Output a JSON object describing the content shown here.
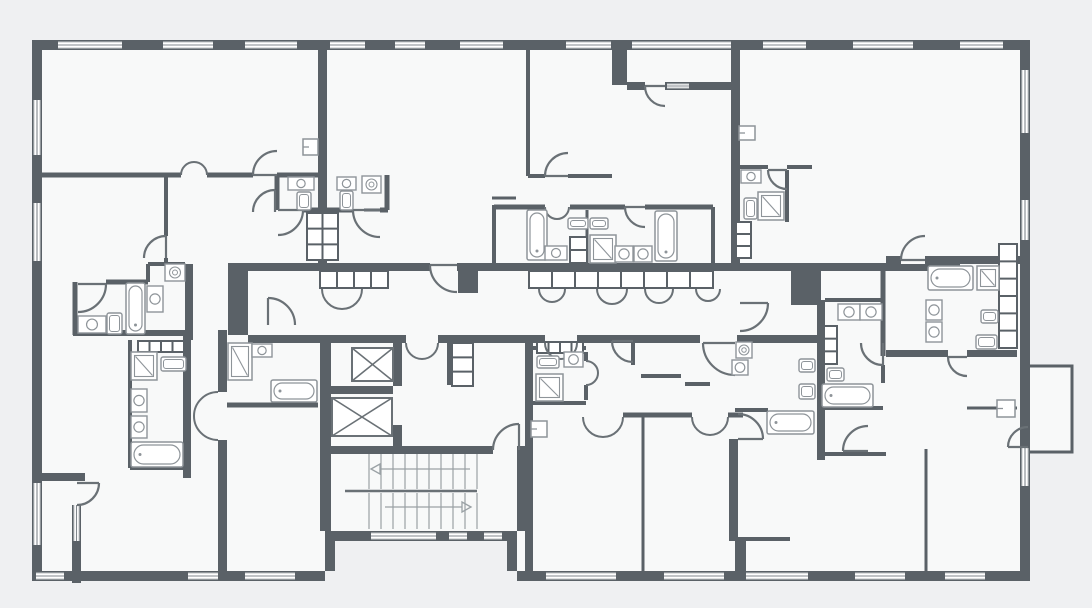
{
  "type": "floor-plan",
  "plan": {
    "canvas": {
      "w": 1092,
      "h": 608
    },
    "colors": {
      "background": "#eff0f2",
      "room": "#f8f9f9",
      "wall": "#5a6167",
      "door": "#6a7176",
      "fixture": "#8e9499",
      "window_line": "#80878c",
      "tread": "#9aa1a5"
    },
    "footprint": "M32,40 H1030 V581 H517 V541 H325 V581 H32 Z",
    "balconies": [
      [
        1028,
        366,
        44,
        86
      ]
    ],
    "walls": [
      [
        32,
        40,
        998,
        10
      ],
      [
        32,
        50,
        10,
        531
      ],
      [
        1020,
        50,
        10,
        531
      ],
      [
        32,
        571,
        293,
        10
      ],
      [
        325,
        531,
        192,
        10
      ],
      [
        325,
        541,
        10,
        30
      ],
      [
        507,
        541,
        10,
        30
      ],
      [
        517,
        571,
        513,
        10
      ],
      [
        318,
        50,
        9,
        213
      ],
      [
        731,
        50,
        9,
        215
      ],
      [
        612,
        40,
        15,
        45
      ],
      [
        627,
        82,
        113,
        8
      ],
      [
        248,
        263,
        712,
        8
      ],
      [
        248,
        335,
        72,
        8
      ],
      [
        478,
        335,
        67,
        8
      ],
      [
        577,
        335,
        123,
        8
      ],
      [
        737,
        335,
        84,
        8
      ],
      [
        228,
        263,
        20,
        72
      ],
      [
        525,
        335,
        8,
        236
      ],
      [
        817,
        300,
        8,
        160
      ],
      [
        320,
        335,
        158,
        8
      ],
      [
        320,
        343,
        11,
        188
      ],
      [
        330,
        386,
        63,
        8
      ],
      [
        320,
        446,
        173,
        8
      ],
      [
        519,
        446,
        8,
        8
      ],
      [
        393,
        343,
        9,
        43
      ],
      [
        393,
        425,
        9,
        21
      ],
      [
        447,
        335,
        7,
        50
      ],
      [
        517,
        446,
        10,
        85
      ],
      [
        185,
        264,
        8,
        76
      ],
      [
        183,
        330,
        8,
        148
      ],
      [
        32,
        473,
        53,
        8
      ],
      [
        72,
        505,
        9,
        78
      ],
      [
        218,
        330,
        9,
        62
      ],
      [
        218,
        440,
        9,
        131
      ],
      [
        458,
        263,
        20,
        30
      ],
      [
        791,
        265,
        30,
        40
      ],
      [
        886,
        256,
        134,
        8
      ],
      [
        886,
        350,
        131,
        7
      ],
      [
        729,
        439,
        9,
        102
      ],
      [
        735,
        541,
        11,
        30
      ]
    ],
    "gaps": [
      [
        430,
        263,
        27,
        8
      ],
      [
        901,
        256,
        24,
        8
      ],
      [
        645,
        82,
        20,
        8
      ],
      [
        948,
        350,
        19,
        7
      ],
      [
        406,
        335,
        32,
        8
      ]
    ],
    "lines": [
      [
        42,
        175,
        181,
        175,
        5
      ],
      [
        207,
        175,
        253,
        175,
        5
      ],
      [
        277,
        175,
        318,
        175,
        5
      ],
      [
        277,
        175,
        277,
        210,
        5
      ],
      [
        387,
        175,
        387,
        210,
        5
      ],
      [
        303,
        210,
        353,
        210,
        5
      ],
      [
        380,
        210,
        388,
        210,
        5
      ],
      [
        166,
        175,
        166,
        236,
        4
      ],
      [
        166,
        258,
        166,
        263,
        4
      ],
      [
        106,
        282,
        148,
        282,
        5
      ],
      [
        75,
        282,
        75,
        335,
        5
      ],
      [
        148,
        264,
        148,
        282,
        4
      ],
      [
        148,
        264,
        185,
        264,
        4
      ],
      [
        73,
        333,
        193,
        333,
        6
      ],
      [
        130,
        340,
        130,
        468,
        4
      ],
      [
        130,
        468,
        183,
        468,
        4
      ],
      [
        227,
        405,
        318,
        405,
        5
      ],
      [
        528,
        50,
        528,
        176,
        4
      ],
      [
        528,
        176,
        545,
        176,
        4
      ],
      [
        568,
        176,
        612,
        176,
        4
      ],
      [
        364,
        210,
        387,
        210,
        3
      ],
      [
        492,
        198,
        516,
        198,
        3
      ],
      [
        494,
        205,
        494,
        263,
        4
      ],
      [
        494,
        207,
        545,
        207,
        5
      ],
      [
        570,
        207,
        625,
        207,
        5
      ],
      [
        645,
        207,
        713,
        207,
        5
      ],
      [
        587,
        210,
        587,
        263,
        3
      ],
      [
        713,
        207,
        713,
        263,
        4
      ],
      [
        740,
        167,
        768,
        167,
        4
      ],
      [
        787,
        167,
        812,
        167,
        4
      ],
      [
        787,
        170,
        787,
        222,
        4
      ],
      [
        883,
        264,
        883,
        356,
        5
      ],
      [
        967,
        408,
        1017,
        408,
        3
      ],
      [
        825,
        300,
        883,
        300,
        4
      ],
      [
        883,
        300,
        883,
        343,
        4
      ],
      [
        883,
        365,
        883,
        383,
        4
      ],
      [
        822,
        408,
        883,
        408,
        4
      ],
      [
        823,
        454,
        886,
        454,
        4
      ],
      [
        926,
        449,
        926,
        571,
        3
      ],
      [
        735,
        410,
        768,
        410,
        4
      ],
      [
        738,
        539,
        790,
        539,
        4
      ],
      [
        533,
        348,
        586,
        348,
        4
      ],
      [
        586,
        352,
        586,
        361,
        4
      ],
      [
        586,
        385,
        586,
        400,
        4
      ],
      [
        533,
        403,
        586,
        403,
        4
      ],
      [
        623,
        415,
        692,
        415,
        5
      ],
      [
        728,
        415,
        743,
        415,
        5
      ],
      [
        633,
        341,
        633,
        365,
        4
      ],
      [
        641,
        376,
        681,
        376,
        4
      ],
      [
        685,
        384,
        710,
        384,
        4
      ],
      [
        643,
        417,
        643,
        571,
        3
      ]
    ],
    "windows": [
      [
        58,
        41,
        64,
        8,
        "h"
      ],
      [
        163,
        41,
        50,
        8,
        "h"
      ],
      [
        245,
        41,
        52,
        8,
        "h"
      ],
      [
        330,
        41,
        35,
        8,
        "h"
      ],
      [
        395,
        41,
        30,
        8,
        "h"
      ],
      [
        460,
        41,
        43,
        8,
        "h"
      ],
      [
        566,
        41,
        45,
        8,
        "h"
      ],
      [
        632,
        41,
        99,
        8,
        "h"
      ],
      [
        763,
        41,
        43,
        8,
        "h"
      ],
      [
        853,
        41,
        60,
        8,
        "h"
      ],
      [
        960,
        41,
        43,
        8,
        "h"
      ],
      [
        667,
        83,
        22,
        6,
        "h"
      ],
      [
        33,
        100,
        8,
        55,
        "v"
      ],
      [
        33,
        203,
        8,
        58,
        "v"
      ],
      [
        33,
        483,
        8,
        62,
        "v"
      ],
      [
        73,
        505,
        7,
        36,
        "v"
      ],
      [
        1021,
        70,
        8,
        63,
        "v"
      ],
      [
        1021,
        200,
        8,
        40,
        "v"
      ],
      [
        1021,
        448,
        8,
        38,
        "v"
      ],
      [
        36,
        572,
        28,
        8,
        "h"
      ],
      [
        188,
        572,
        30,
        8,
        "h"
      ],
      [
        245,
        572,
        50,
        8,
        "h"
      ],
      [
        371,
        532,
        65,
        8,
        "h"
      ],
      [
        449,
        532,
        18,
        8,
        "h"
      ],
      [
        484,
        532,
        18,
        8,
        "h"
      ],
      [
        546,
        572,
        70,
        8,
        "h"
      ],
      [
        664,
        572,
        60,
        8,
        "h"
      ],
      [
        746,
        572,
        62,
        8,
        "h"
      ],
      [
        855,
        572,
        50,
        8,
        "h"
      ],
      [
        945,
        572,
        40,
        8,
        "h"
      ]
    ],
    "doors": [
      [
        277,
        175,
        24,
        180,
        270
      ],
      [
        278,
        210,
        25,
        0,
        90
      ],
      [
        380,
        210,
        27,
        180,
        90
      ],
      [
        275,
        212,
        22,
        270,
        180
      ],
      [
        78,
        284,
        28,
        0,
        90
      ],
      [
        166,
        258,
        22,
        270,
        180
      ],
      [
        77,
        483,
        22,
        0,
        90
      ],
      [
        568,
        176,
        23,
        180,
        270
      ],
      [
        457,
        265,
        27,
        180,
        90
      ],
      [
        645,
        207,
        20,
        180,
        90
      ],
      [
        665,
        86,
        20,
        180,
        90
      ],
      [
        740,
        303,
        28,
        0,
        90
      ],
      [
        787,
        170,
        19,
        180,
        90
      ],
      [
        925,
        260,
        24,
        180,
        270
      ],
      [
        967,
        357,
        19,
        180,
        90
      ],
      [
        1028,
        447,
        20,
        180,
        270
      ],
      [
        883,
        343,
        22,
        90,
        180
      ],
      [
        868,
        451,
        25,
        180,
        270
      ],
      [
        738,
        439,
        25,
        0,
        270
      ],
      [
        268,
        325,
        27,
        270,
        0
      ],
      [
        519,
        450,
        26,
        270,
        180
      ],
      [
        633,
        341,
        21,
        180,
        90
      ],
      [
        735,
        343,
        32,
        180,
        90
      ]
    ],
    "double_doors": [
      [
        194,
        175,
        13,
        "up"
      ],
      [
        342,
        289,
        20,
        "down"
      ],
      [
        557,
        207,
        12,
        "down"
      ],
      [
        552,
        289,
        13,
        "down"
      ],
      [
        612,
        289,
        15,
        "down"
      ],
      [
        659,
        289,
        14,
        "down"
      ],
      [
        708,
        289,
        12,
        "down"
      ],
      [
        422,
        343,
        16,
        "down"
      ],
      [
        561,
        343,
        16,
        "down"
      ],
      [
        603,
        417,
        20,
        "down"
      ],
      [
        710,
        417,
        18,
        "down"
      ],
      [
        586,
        373,
        12,
        "right"
      ],
      [
        218,
        416,
        24,
        "left"
      ]
    ],
    "stairs": {
      "x0": 369,
      "x1": 477,
      "step": 12,
      "flights": [
        [
          454,
          489
        ],
        [
          493,
          529
        ]
      ],
      "rail": [
        345,
        491,
        477,
        491
      ],
      "arrows": [
        {
          "tail": [
            470,
            469,
            380,
            469
          ],
          "tip": [
            371,
            469
          ],
          "dir": "left"
        },
        {
          "tail": [
            385,
            507,
            462,
            507
          ],
          "tip": [
            471,
            507
          ],
          "dir": "right"
        }
      ]
    },
    "fixtures": {
      "elevators": [
        [
          352,
          348,
          41,
          33
        ],
        [
          332,
          398,
          60,
          38
        ]
      ],
      "bathtubs": [
        [
          126,
          283,
          19,
          51,
          "v"
        ],
        [
          131,
          442,
          52,
          25,
          "h"
        ],
        [
          271,
          380,
          46,
          22,
          "h"
        ],
        [
          527,
          210,
          20,
          50,
          "v"
        ],
        [
          655,
          211,
          22,
          50,
          "v"
        ],
        [
          928,
          266,
          45,
          24,
          "h"
        ],
        [
          822,
          384,
          51,
          23,
          "h"
        ],
        [
          767,
          411,
          47,
          23,
          "h"
        ]
      ],
      "showers": [
        [
          131,
          352,
          26,
          28
        ],
        [
          228,
          343,
          24,
          37
        ],
        [
          590,
          235,
          26,
          28
        ],
        [
          758,
          192,
          26,
          28
        ],
        [
          977,
          266,
          22,
          24
        ],
        [
          536,
          374,
          27,
          27
        ]
      ],
      "sinks": [
        [
          78,
          316,
          28,
          17
        ],
        [
          147,
          286,
          16,
          26
        ],
        [
          131,
          389,
          16,
          23
        ],
        [
          131,
          416,
          16,
          22
        ],
        [
          288,
          177,
          26,
          13
        ],
        [
          337,
          177,
          19,
          13
        ],
        [
          545,
          246,
          22,
          14
        ],
        [
          615,
          246,
          18,
          16
        ],
        [
          634,
          246,
          18,
          16
        ],
        [
          252,
          344,
          20,
          13
        ],
        [
          564,
          352,
          19,
          15
        ],
        [
          741,
          170,
          20,
          13
        ],
        [
          926,
          300,
          16,
          20
        ],
        [
          926,
          322,
          16,
          20
        ],
        [
          838,
          304,
          22,
          16
        ],
        [
          860,
          304,
          22,
          16
        ],
        [
          732,
          360,
          16,
          15
        ]
      ],
      "toilets": [
        [
          297,
          192,
          14,
          18
        ],
        [
          340,
          191,
          13,
          19
        ],
        [
          107,
          313,
          15,
          21
        ],
        [
          161,
          357,
          25,
          14
        ],
        [
          568,
          218,
          20,
          11
        ],
        [
          590,
          218,
          18,
          11
        ],
        [
          744,
          198,
          13,
          21
        ],
        [
          537,
          356,
          22,
          12
        ],
        [
          981,
          310,
          17,
          13
        ],
        [
          976,
          335,
          21,
          14
        ],
        [
          827,
          368,
          17,
          13
        ],
        [
          799,
          359,
          16,
          13
        ],
        [
          799,
          384,
          16,
          15
        ]
      ],
      "washers": [
        [
          165,
          264,
          20,
          17
        ],
        [
          362,
          176,
          19,
          17
        ],
        [
          736,
          342,
          16,
          16
        ]
      ],
      "wall_boxes": [
        [
          303,
          139,
          15,
          16
        ],
        [
          739,
          126,
          16,
          14
        ],
        [
          531,
          421,
          16,
          16
        ],
        [
          997,
          400,
          18,
          17
        ]
      ],
      "shaft_cells": [
        [
          320,
          271,
          68,
          17,
          4,
          1
        ],
        [
          529,
          271,
          184,
          17,
          8,
          1
        ],
        [
          570,
          237,
          17,
          26,
          1,
          2
        ],
        [
          307,
          213,
          31,
          47,
          2,
          3
        ],
        [
          138,
          341,
          46,
          11,
          4,
          1
        ],
        [
          537,
          342,
          46,
          11,
          4,
          1
        ],
        [
          736,
          222,
          15,
          36,
          1,
          3
        ],
        [
          999,
          244,
          18,
          104,
          1,
          6
        ],
        [
          824,
          326,
          13,
          38,
          1,
          3
        ],
        [
          452,
          343,
          21,
          43,
          1,
          3
        ]
      ]
    }
  }
}
